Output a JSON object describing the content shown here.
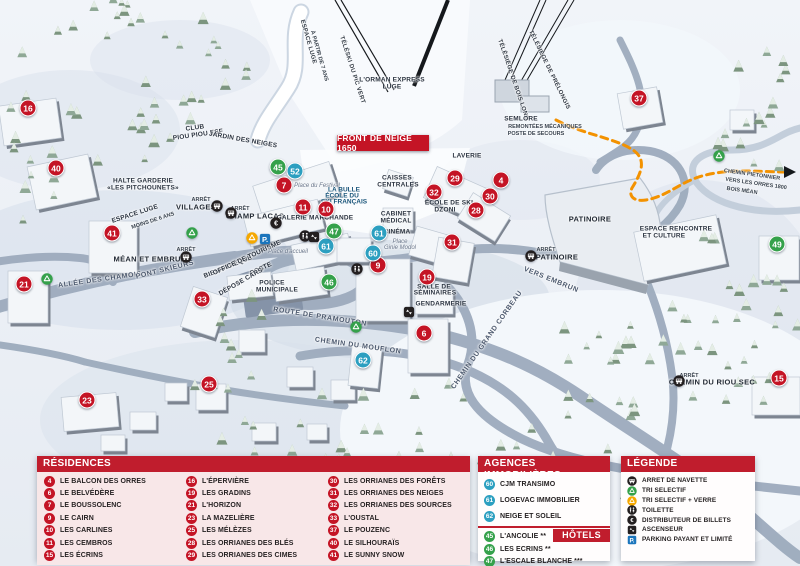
{
  "map": {
    "banner": "FRONT DE NEIGE 1650",
    "markers": [
      {
        "n": "16",
        "t": "res",
        "x": 28,
        "y": 108
      },
      {
        "n": "40",
        "t": "res",
        "x": 56,
        "y": 168
      },
      {
        "n": "41",
        "t": "res",
        "x": 112,
        "y": 233
      },
      {
        "n": "21",
        "t": "res",
        "x": 24,
        "y": 284
      },
      {
        "n": "33",
        "t": "res",
        "x": 202,
        "y": 299
      },
      {
        "n": "23",
        "t": "res",
        "x": 87,
        "y": 400
      },
      {
        "n": "25",
        "t": "res",
        "x": 209,
        "y": 384
      },
      {
        "n": "7",
        "t": "res",
        "x": 284,
        "y": 185
      },
      {
        "n": "11",
        "t": "res",
        "x": 303,
        "y": 207
      },
      {
        "n": "10",
        "t": "res",
        "x": 326,
        "y": 209
      },
      {
        "n": "9",
        "t": "res",
        "x": 378,
        "y": 265
      },
      {
        "n": "19",
        "t": "res",
        "x": 427,
        "y": 277
      },
      {
        "n": "6",
        "t": "res",
        "x": 424,
        "y": 333
      },
      {
        "n": "29",
        "t": "res",
        "x": 455,
        "y": 178
      },
      {
        "n": "4",
        "t": "res",
        "x": 501,
        "y": 180
      },
      {
        "n": "32",
        "t": "res",
        "x": 434,
        "y": 192
      },
      {
        "n": "30",
        "t": "res",
        "x": 490,
        "y": 196
      },
      {
        "n": "28",
        "t": "res",
        "x": 476,
        "y": 210
      },
      {
        "n": "31",
        "t": "res",
        "x": 452,
        "y": 242
      },
      {
        "n": "37",
        "t": "res",
        "x": 639,
        "y": 98
      },
      {
        "n": "15",
        "t": "res",
        "x": 779,
        "y": 378
      },
      {
        "n": "52",
        "t": "ag",
        "x": 295,
        "y": 171
      },
      {
        "n": "61",
        "t": "ag",
        "x": 326,
        "y": 246
      },
      {
        "n": "61",
        "t": "ag",
        "x": 379,
        "y": 233
      },
      {
        "n": "60",
        "t": "ag",
        "x": 373,
        "y": 253
      },
      {
        "n": "62",
        "t": "ag",
        "x": 363,
        "y": 360
      },
      {
        "n": "45",
        "t": "ho",
        "x": 278,
        "y": 167
      },
      {
        "n": "47",
        "t": "ho",
        "x": 334,
        "y": 231
      },
      {
        "n": "46",
        "t": "ho",
        "x": 329,
        "y": 282
      },
      {
        "n": "49",
        "t": "ho",
        "x": 777,
        "y": 244
      }
    ],
    "icons": [
      {
        "k": "bus",
        "x": 217,
        "y": 206
      },
      {
        "k": "bus",
        "x": 231,
        "y": 213
      },
      {
        "k": "bus",
        "x": 186,
        "y": 257
      },
      {
        "k": "bus",
        "x": 531,
        "y": 256
      },
      {
        "k": "bus",
        "x": 679,
        "y": 381
      },
      {
        "k": "eur",
        "x": 276,
        "y": 223
      },
      {
        "k": "toilet",
        "x": 305,
        "y": 236
      },
      {
        "k": "elev",
        "x": 314,
        "y": 237
      },
      {
        "k": "toilet",
        "x": 357,
        "y": 269
      },
      {
        "k": "elev",
        "x": 409,
        "y": 312
      },
      {
        "k": "recg",
        "x": 47,
        "y": 279
      },
      {
        "k": "recg",
        "x": 192,
        "y": 233
      },
      {
        "k": "recg",
        "x": 356,
        "y": 327
      },
      {
        "k": "recg",
        "x": 719,
        "y": 156
      },
      {
        "k": "reco",
        "x": 252,
        "y": 238
      },
      {
        "k": "park",
        "x": 265,
        "y": 239
      }
    ],
    "labels": [
      {
        "t": "ESPACE LUGE",
        "x": 308,
        "y": 42,
        "r": 74,
        "s": "lift"
      },
      {
        "t": "À PARTIR DE 7 ANS",
        "x": 319,
        "y": 56,
        "r": 74,
        "s": "tiny"
      },
      {
        "t": "TÉLÉSKI DU PIC VERT",
        "x": 352,
        "y": 70,
        "r": 72,
        "s": "lift"
      },
      {
        "t": "L'ORMAN EXPRESS",
        "x": 392,
        "y": 80,
        "r": 0,
        "s": "poi"
      },
      {
        "t": "LUGE",
        "x": 392,
        "y": 87,
        "r": 0,
        "s": "poi"
      },
      {
        "t": "TÉLÉSIÈGE DE BOIS LONG",
        "x": 513,
        "y": 80,
        "r": 71,
        "s": "lift"
      },
      {
        "t": "TÉLÉSIÈGE DE PRÉLONGIS",
        "x": 549,
        "y": 70,
        "r": 64,
        "s": "lift"
      },
      {
        "t": "SEMLORE",
        "x": 521,
        "y": 119,
        "r": 0,
        "s": "poi"
      },
      {
        "t": "REMONTÉES MÉCANIQUES",
        "x": 545,
        "y": 127,
        "r": 0,
        "s": "tiny"
      },
      {
        "t": "POSTE DE SECOURS",
        "x": 536,
        "y": 134,
        "r": 0,
        "s": "tiny"
      },
      {
        "t": "CLUB",
        "x": 195,
        "y": 128,
        "r": -8,
        "s": "poi"
      },
      {
        "t": "PIOU PIOU ESF",
        "x": 198,
        "y": 135,
        "r": -8,
        "s": "poi"
      },
      {
        "t": "JARDIN DES NEIGES",
        "x": 243,
        "y": 140,
        "r": 10,
        "s": "poi"
      },
      {
        "t": "HALTE GARDERIE",
        "x": 143,
        "y": 181,
        "r": 0,
        "s": "poi"
      },
      {
        "t": "«LES PITCHOUNETS»",
        "x": 143,
        "y": 188,
        "r": 0,
        "s": "poi"
      },
      {
        "t": "ARRÊT",
        "x": 201,
        "y": 200,
        "r": 0,
        "s": "tiny"
      },
      {
        "t": "VILLAGES",
        "x": 196,
        "y": 207,
        "r": 0,
        "s": "poibig"
      },
      {
        "t": "ESPACE LUGE",
        "x": 135,
        "y": 214,
        "r": -18,
        "s": "poi"
      },
      {
        "t": "MOINS DE 6 ANS",
        "x": 153,
        "y": 221,
        "r": -18,
        "s": "tiny"
      },
      {
        "t": "ARRÊT",
        "x": 240,
        "y": 209,
        "r": 0,
        "s": "tiny"
      },
      {
        "t": "CHAMP LACAS",
        "x": 255,
        "y": 216,
        "r": 0,
        "s": "poibig"
      },
      {
        "t": "Place du Festival",
        "x": 317,
        "y": 186,
        "r": 0,
        "s": "place"
      },
      {
        "t": "LA BULLE",
        "x": 344,
        "y": 190,
        "r": 0,
        "s": "blue"
      },
      {
        "t": "ÉCOLE DU",
        "x": 342,
        "y": 196,
        "r": 0,
        "s": "blue"
      },
      {
        "t": "SKI FRANÇAIS",
        "x": 344,
        "y": 202,
        "r": 0,
        "s": "blue"
      },
      {
        "t": "CAISSES",
        "x": 397,
        "y": 178,
        "r": 0,
        "s": "poi"
      },
      {
        "t": "CENTRALES",
        "x": 398,
        "y": 185,
        "r": 0,
        "s": "poi"
      },
      {
        "t": "GALERIE MARCHANDE",
        "x": 315,
        "y": 218,
        "r": 0,
        "s": "poi"
      },
      {
        "t": "CABINET",
        "x": 396,
        "y": 214,
        "r": 0,
        "s": "poi"
      },
      {
        "t": "MÉDICAL",
        "x": 396,
        "y": 221,
        "r": 0,
        "s": "poi"
      },
      {
        "t": "CINÉMA",
        "x": 397,
        "y": 232,
        "r": 0,
        "s": "poi"
      },
      {
        "t": "Place",
        "x": 400,
        "y": 242,
        "r": 0,
        "s": "place"
      },
      {
        "t": "Ginie Modol",
        "x": 400,
        "y": 248,
        "r": 0,
        "s": "place"
      },
      {
        "t": "ÉCOLE DE SKI",
        "x": 449,
        "y": 203,
        "r": 0,
        "s": "poi"
      },
      {
        "t": "DZONI",
        "x": 445,
        "y": 210,
        "r": 0,
        "s": "poi"
      },
      {
        "t": "LAVERIE",
        "x": 467,
        "y": 156,
        "r": 0,
        "s": "poi"
      },
      {
        "t": "PATINOIRE",
        "x": 590,
        "y": 219,
        "r": 0,
        "s": "poibig"
      },
      {
        "t": "ARRÊT",
        "x": 546,
        "y": 250,
        "r": 0,
        "s": "tiny"
      },
      {
        "t": "PATINOIRE",
        "x": 557,
        "y": 257,
        "r": 0,
        "s": "poibig"
      },
      {
        "t": "ESPACE RENCONTRE",
        "x": 676,
        "y": 229,
        "r": 0,
        "s": "poi"
      },
      {
        "t": "ET CULTURE",
        "x": 664,
        "y": 236,
        "r": 0,
        "s": "poi"
      },
      {
        "t": "CHEMIN PIETONNIER",
        "x": 752,
        "y": 175,
        "r": 8,
        "s": "tiny"
      },
      {
        "t": "VERS LES ORRES 1800",
        "x": 756,
        "y": 184,
        "r": 8,
        "s": "tiny"
      },
      {
        "t": "BOIS MÉAN",
        "x": 742,
        "y": 191,
        "r": 8,
        "s": "tiny"
      },
      {
        "t": "VERS EMBRUN",
        "x": 551,
        "y": 280,
        "r": 22,
        "s": "road"
      },
      {
        "t": "ALLÉE DES CHAMOIS",
        "x": 100,
        "y": 280,
        "r": -8,
        "s": "road"
      },
      {
        "t": "PONT SKIEURS",
        "x": 165,
        "y": 270,
        "r": -14,
        "s": "road"
      },
      {
        "t": "ARRÊT",
        "x": 186,
        "y": 250,
        "r": 0,
        "s": "tiny"
      },
      {
        "t": "MÉAN ET EMBRUN",
        "x": 150,
        "y": 259,
        "r": 0,
        "s": "poibig"
      },
      {
        "t": "BIBLIOTHÈQUE",
        "x": 228,
        "y": 267,
        "r": -22,
        "s": "poi"
      },
      {
        "t": "OFFICE DE TOURISME",
        "x": 247,
        "y": 258,
        "r": -25,
        "s": "poi"
      },
      {
        "t": "POSTE",
        "x": 261,
        "y": 269,
        "r": -25,
        "s": "poi"
      },
      {
        "t": "DÉPOSE CARS",
        "x": 241,
        "y": 282,
        "r": -30,
        "s": "poi"
      },
      {
        "t": "POLICE",
        "x": 272,
        "y": 283,
        "r": 0,
        "s": "poi"
      },
      {
        "t": "MUNICIPALE",
        "x": 277,
        "y": 290,
        "r": 0,
        "s": "poi"
      },
      {
        "t": "Place d'accueil",
        "x": 288,
        "y": 252,
        "r": 0,
        "s": "place"
      },
      {
        "t": "ROUTE DE PRAMOUTON",
        "x": 320,
        "y": 317,
        "r": 9,
        "s": "road"
      },
      {
        "t": "CHEMIN DU MOUFLON",
        "x": 358,
        "y": 346,
        "r": 8,
        "s": "road"
      },
      {
        "t": "SALLE DE",
        "x": 434,
        "y": 287,
        "r": 0,
        "s": "poi"
      },
      {
        "t": "SÉMINAIRES",
        "x": 435,
        "y": 293,
        "r": 0,
        "s": "poi"
      },
      {
        "t": "GENDARMERIE",
        "x": 441,
        "y": 304,
        "r": 0,
        "s": "poi"
      },
      {
        "t": "CHEMIN DU GRAND CORBEAU",
        "x": 487,
        "y": 340,
        "r": -55,
        "s": "road"
      },
      {
        "t": "ARRÊT",
        "x": 689,
        "y": 376,
        "r": 0,
        "s": "tiny"
      },
      {
        "t": "CHEMIN DU RIOU SEC",
        "x": 712,
        "y": 382,
        "r": 0,
        "s": "poibig"
      }
    ]
  },
  "panels": {
    "residences": {
      "title": "RÉSIDENCES",
      "items": [
        {
          "n": "4",
          "label": "LE BALCON DES ORRES"
        },
        {
          "n": "6",
          "label": "LE BELVÉDÈRE"
        },
        {
          "n": "7",
          "label": "LE BOUSSOLENC"
        },
        {
          "n": "9",
          "label": "LE CAIRN"
        },
        {
          "n": "10",
          "label": "LES CARLINES"
        },
        {
          "n": "11",
          "label": "LES CEMBROS"
        },
        {
          "n": "15",
          "label": "LES ÉCRINS"
        },
        {
          "n": "16",
          "label": "L'ÉPERVIÈRE"
        },
        {
          "n": "19",
          "label": "LES GRADINS"
        },
        {
          "n": "21",
          "label": "L'HORIZON"
        },
        {
          "n": "23",
          "label": "LA MAZELIÈRE"
        },
        {
          "n": "25",
          "label": "LES MÉLÈZES"
        },
        {
          "n": "28",
          "label": "LES ORRIANES DES BLÉS"
        },
        {
          "n": "29",
          "label": "LES ORRIANES DES CIMES"
        },
        {
          "n": "30",
          "label": "LES ORRIANES DES FORÊTS"
        },
        {
          "n": "31",
          "label": "LES ORRIANES DES NEIGES"
        },
        {
          "n": "32",
          "label": "LES ORRIANES DES SOURCES"
        },
        {
          "n": "33",
          "label": "L'OUSTAL"
        },
        {
          "n": "37",
          "label": "LE POUZENC"
        },
        {
          "n": "40",
          "label": "LE SILHOURAÏS"
        },
        {
          "n": "41",
          "label": "LE SUNNY SNOW"
        }
      ]
    },
    "agences": {
      "title": "AGENCES IMMOBILIÈRES",
      "items": [
        {
          "n": "60",
          "label": "CJM TRANSIMO"
        },
        {
          "n": "61",
          "label": "LOGEVAC IMMOBILIER"
        },
        {
          "n": "62",
          "label": "NEIGE ET SOLEIL"
        }
      ]
    },
    "hotels": {
      "title": "HÔTELS",
      "items": [
        {
          "n": "45",
          "label": "L'ANCOLIE **"
        },
        {
          "n": "46",
          "label": "LES ECRINS **"
        },
        {
          "n": "47",
          "label": "L'ESCALE BLANCHE ***"
        },
        {
          "n": "49",
          "label": "LES TRAPPEURS **"
        }
      ]
    },
    "legende": {
      "title": "LÉGENDE",
      "items": [
        {
          "icon": "bus",
          "label": "ARRET DE NAVETTE"
        },
        {
          "icon": "recg",
          "label": "TRI SELECTIF"
        },
        {
          "icon": "reco",
          "label": "TRI SELECTIF + VERRE"
        },
        {
          "icon": "toilet",
          "label": "TOILETTE"
        },
        {
          "icon": "eur",
          "label": "DISTRIBUTEUR DE BILLETS"
        },
        {
          "icon": "elev",
          "label": "ASCENSEUR"
        },
        {
          "icon": "park",
          "label": "PARKING PAYANT ET LIMITÉ"
        }
      ]
    }
  },
  "colors": {
    "residence_marker": "#c41425",
    "agency_marker": "#2c9fc0",
    "hotel_marker": "#35a14b",
    "panel_header": "#c01d2d",
    "parking_blue": "#1b75bc",
    "path_orange": "#f39200"
  }
}
